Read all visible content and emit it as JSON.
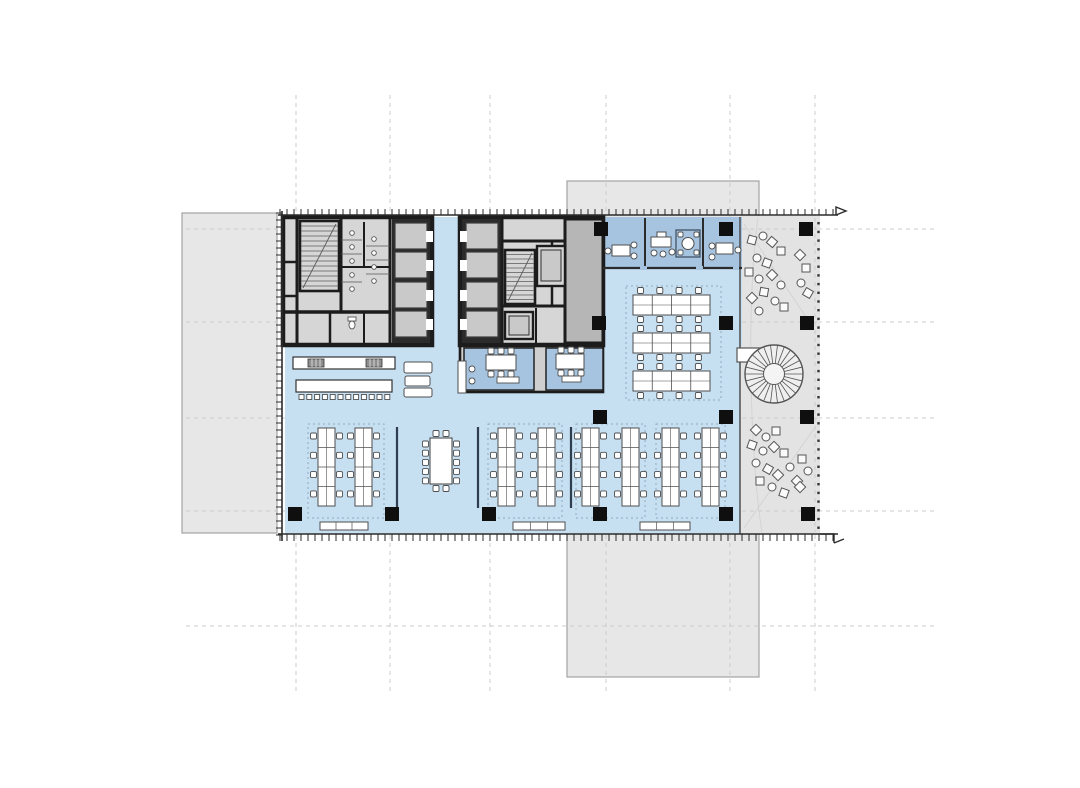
{
  "document": {
    "kind": "architectural-floor-plan",
    "description": "Office tower typical floor plan: two service cores, open-plan workstations, meeting rooms, cafe counter, terrace with spiral stair"
  },
  "palette": {
    "bg": "#ffffff",
    "slab_fill": "#e7e7e7",
    "slab_stroke": "#a3a3a3",
    "grid": "#cbcbcb",
    "blue_open": "#c6dff1",
    "blue_room": "#a6c4e0",
    "core_floor": "#d6d6d6",
    "core_wall": "#1c1c1c",
    "shaft": "#2b2b2b",
    "car_fill": "#c9c9c9",
    "car_stroke": "#3c3c3c",
    "gray_room": "#b6b6b6",
    "band_gray": "#cfcfcf",
    "terrace": "#e3e3e3",
    "terrace_path": "#d2d2d2",
    "furn_stroke": "#4f4f4f",
    "furn_fill": "#ffffff",
    "zone_dash": "#93a9bd",
    "partition": "#2f3e4e",
    "column": "#0f0f0f",
    "tick": "#2b2b2b",
    "fixture": "#555555"
  },
  "canvas": {
    "w": 1080,
    "h": 788
  },
  "context_slabs": [
    [
      182,
      213,
      95,
      320
    ],
    [
      567,
      181,
      192,
      496
    ]
  ],
  "grid": {
    "v": [
      296,
      390,
      490,
      606,
      730,
      815
    ],
    "v_y": [
      95,
      691
    ],
    "h": [
      229,
      322,
      418,
      511,
      626
    ],
    "h_x": [
      186,
      938
    ]
  },
  "areas": {
    "open": [
      [
        285,
        345,
        455,
        189
      ],
      [
        430,
        217,
        32,
        130
      ],
      [
        603,
        268,
        139,
        78
      ]
    ],
    "terrace": [
      740,
      216,
      80,
      318
    ],
    "meeting_band": [
      603,
      217,
      139,
      51
    ],
    "boundary": [
      740,
      217,
      740,
      534
    ]
  },
  "facade": {
    "top": {
      "x1": 278,
      "x2": 838,
      "y": 215,
      "step": 7,
      "len": 6
    },
    "bottom": {
      "x1": 278,
      "x2": 838,
      "y": 534,
      "step": 7,
      "len": 7
    },
    "left": {
      "x": 282,
      "y1": 211,
      "y2": 541,
      "step": 7,
      "len": 6
    },
    "right_dots": {
      "x": 818.5,
      "y1": 222,
      "y2": 530,
      "step": 8.7,
      "size": 2.4
    },
    "hooks": [
      "M836,215 l0,-8 l10,4 l-10,4",
      "M820,534 l14,0 l0,9",
      "M834,543 l10,-4"
    ]
  },
  "core1": {
    "base": [
      283,
      217,
      149,
      128
    ],
    "walls": [
      [
        297,
        219,
        297,
        343,
        3
      ],
      [
        341,
        219,
        341,
        312,
        3
      ],
      [
        390,
        219,
        390,
        343,
        3
      ],
      [
        283,
        262,
        297,
        262,
        2.5
      ],
      [
        283,
        296,
        297,
        296,
        2.5
      ],
      [
        285,
        312,
        390,
        312,
        3.5
      ],
      [
        330,
        312,
        330,
        343,
        2.5
      ],
      [
        364,
        222,
        364,
        267,
        2
      ],
      [
        341,
        267,
        390,
        267,
        2
      ],
      [
        364,
        312,
        364,
        343,
        2
      ]
    ],
    "stair": {
      "x": 300,
      "y": 221,
      "w": 39,
      "h": 70,
      "n": 13
    },
    "shaft": {
      "x": 392,
      "y": 219,
      "w": 38,
      "h": 124
    },
    "cars": [
      {
        "x": 395,
        "y": 223,
        "w": 32,
        "h": 26,
        "door": "R"
      },
      {
        "x": 395,
        "y": 252,
        "w": 32,
        "h": 26,
        "door": "R"
      },
      {
        "x": 395,
        "y": 282,
        "w": 32,
        "h": 26,
        "door": "R"
      },
      {
        "x": 395,
        "y": 311,
        "w": 32,
        "h": 26,
        "door": "R"
      }
    ],
    "urinals": [
      [
        352,
        233
      ],
      [
        352,
        247
      ],
      [
        352,
        261
      ],
      [
        352,
        275
      ],
      [
        352,
        289
      ],
      [
        374,
        239
      ],
      [
        374,
        253
      ],
      [
        374,
        267
      ],
      [
        374,
        281
      ]
    ],
    "stalls": [
      [
        341,
        240,
        362,
        240
      ],
      [
        341,
        254,
        362,
        254
      ],
      [
        366,
        246,
        390,
        246
      ],
      [
        366,
        260,
        390,
        260
      ],
      [
        366,
        274,
        390,
        274
      ],
      [
        341,
        282,
        362,
        282
      ]
    ],
    "wc": [
      [
        352,
        325
      ]
    ]
  },
  "core2": {
    "base": [
      460,
      217,
      143,
      128
    ],
    "walls": [
      [
        502,
        219,
        502,
        343,
        3
      ],
      [
        565,
        219,
        565,
        343,
        3
      ],
      [
        502,
        241,
        565,
        241,
        3
      ],
      [
        502,
        306,
        565,
        306,
        3
      ],
      [
        552,
        241,
        552,
        306,
        2.5
      ],
      [
        536,
        308,
        536,
        343,
        2
      ]
    ],
    "stair": {
      "x": 505,
      "y": 250,
      "w": 30,
      "h": 54,
      "n": 11
    },
    "shaft": {
      "x": 462,
      "y": 219,
      "w": 40,
      "h": 124
    },
    "cars": [
      {
        "x": 466,
        "y": 223,
        "w": 32,
        "h": 26,
        "door": "L"
      },
      {
        "x": 466,
        "y": 252,
        "w": 32,
        "h": 26,
        "door": "L"
      },
      {
        "x": 466,
        "y": 282,
        "w": 32,
        "h": 26,
        "door": "L"
      },
      {
        "x": 466,
        "y": 311,
        "w": 32,
        "h": 26,
        "door": "L"
      }
    ],
    "elev_box": {
      "box": [
        537,
        246,
        28,
        40
      ],
      "car": [
        541,
        250,
        20,
        31
      ]
    },
    "svc": {
      "box": [
        505,
        312,
        28,
        27
      ],
      "car": [
        509,
        316,
        20,
        19
      ]
    },
    "right_room": [
      565,
      219,
      38,
      124
    ]
  },
  "meeting_small": {
    "band": [
      460,
      346,
      143,
      46
    ],
    "rooms": [
      [
        464,
        348,
        70,
        42
      ],
      [
        546,
        348,
        57,
        42
      ]
    ],
    "tables": [
      {
        "x": 486,
        "y": 355,
        "w": 30,
        "h": 15,
        "chairs": 3
      },
      {
        "x": 556,
        "y": 354,
        "w": 28,
        "h": 15,
        "chairs": 3
      }
    ],
    "sideboards": [
      [
        497,
        377,
        22,
        6
      ],
      [
        562,
        376,
        19,
        6
      ]
    ]
  },
  "top_rooms": {
    "partitions": [
      645,
      703
    ],
    "wall_y": 268,
    "wall_x": [
      603,
      742
    ],
    "door_gaps": [
      [
        640,
        7
      ],
      [
        696,
        7
      ],
      [
        733,
        6
      ]
    ],
    "desks": [
      {
        "r": [
          612,
          245,
          18,
          11
        ],
        "chairs": [
          [
            608,
            251
          ],
          [
            634,
            245
          ],
          [
            634,
            256
          ]
        ]
      },
      {
        "r": [
          651,
          237,
          20,
          10
        ],
        "tab": [
          657,
          232,
          9,
          5
        ],
        "chairs": [
          [
            654,
            253
          ],
          [
            663,
            254
          ],
          [
            672,
            252
          ]
        ]
      },
      {
        "r": [
          716,
          243,
          17,
          11
        ],
        "chairs": [
          [
            712,
            246
          ],
          [
            712,
            257
          ],
          [
            738,
            250
          ]
        ]
      }
    ],
    "table_box": {
      "box": [
        676,
        230,
        24,
        27
      ],
      "circle": [
        688,
        243.5,
        6
      ],
      "seats": [
        [
          678,
          232
        ],
        [
          694,
          232
        ],
        [
          678,
          250
        ],
        [
          694,
          250
        ]
      ]
    }
  },
  "desk_rows": {
    "rows": [
      [
        633,
        295
      ],
      [
        633,
        333
      ],
      [
        633,
        371
      ]
    ],
    "w": 77,
    "h": 20,
    "cols": 4,
    "chairs": 4,
    "zone": [
      626,
      286,
      95,
      114
    ]
  },
  "desk_banks": {
    "x": [
      318,
      355,
      498,
      538,
      582,
      622,
      662,
      702
    ],
    "y": 428,
    "w": 17,
    "h": 78,
    "rows": 4,
    "zones": [
      [
        308,
        424,
        76,
        94
      ],
      [
        488,
        424,
        74,
        94
      ],
      [
        576,
        424,
        69,
        94
      ],
      [
        656,
        424,
        69,
        94
      ]
    ],
    "partitions": [
      397,
      478,
      571
    ],
    "part_y": [
      427,
      508
    ]
  },
  "conference": {
    "table": [
      430,
      438,
      22,
      46
    ],
    "side_chairs": 5,
    "end_chairs": 2
  },
  "counters": {
    "a": [
      293,
      357,
      102,
      12
    ],
    "a_patches": [
      [
        308,
        359,
        16,
        8
      ],
      [
        366,
        359,
        16,
        8
      ]
    ],
    "b": [
      296,
      380,
      96,
      12
    ],
    "stools": {
      "y": 394.5,
      "x0": 299,
      "n": 12,
      "step": 7.8,
      "s": 5
    }
  },
  "lounge": [
    [
      404,
      362,
      28,
      11
    ],
    [
      405,
      376,
      25,
      10
    ],
    [
      404,
      388,
      28,
      9
    ]
  ],
  "high_table": {
    "rect": [
      458,
      361,
      8,
      32
    ],
    "stools": [
      [
        472,
        369
      ],
      [
        472,
        381
      ]
    ]
  },
  "benches": [
    [
      320,
      522,
      48,
      8
    ],
    [
      513,
      522,
      52,
      8
    ],
    [
      640,
      522,
      50,
      8
    ]
  ],
  "columns": {
    "size": 14,
    "pts": [
      [
        594,
        222
      ],
      [
        719,
        222
      ],
      [
        799,
        222
      ],
      [
        592,
        316
      ],
      [
        719,
        316
      ],
      [
        800,
        316
      ],
      [
        593,
        410
      ],
      [
        719,
        410
      ],
      [
        800,
        410
      ],
      [
        288,
        507
      ],
      [
        385,
        507
      ],
      [
        482,
        507
      ],
      [
        593,
        507
      ],
      [
        719,
        507
      ],
      [
        801,
        507
      ]
    ]
  },
  "terrace_detail": {
    "overlay_h": [
      229,
      322,
      418,
      511
    ],
    "overlay_hx": [
      742,
      817
    ],
    "overlay_v": 815,
    "overlay_vy": [
      218,
      532
    ],
    "paths": [
      "M744,224 L816,332",
      "M744,528 L816,426",
      "M758,218 C746,300 750,460 762,532"
    ],
    "spiral": {
      "cx": 774,
      "cy": 374,
      "r_out": 29,
      "r_in": 10.5,
      "spokes": 26
    },
    "landing": [
      737,
      348,
      38,
      14
    ],
    "scatter": [
      [
        752,
        240,
        "s",
        15
      ],
      [
        763,
        236,
        "c",
        0
      ],
      [
        772,
        242,
        "s",
        40
      ],
      [
        781,
        251,
        "s",
        0
      ],
      [
        757,
        258,
        "c",
        0
      ],
      [
        767,
        263,
        "s",
        20
      ],
      [
        749,
        272,
        "s",
        0
      ],
      [
        759,
        279,
        "c",
        0
      ],
      [
        772,
        275,
        "s",
        45
      ],
      [
        781,
        285,
        "c",
        0
      ],
      [
        764,
        292,
        "s",
        10
      ],
      [
        752,
        298,
        "s",
        45
      ],
      [
        775,
        301,
        "c",
        0
      ],
      [
        784,
        307,
        "s",
        0
      ],
      [
        759,
        311,
        "c",
        0
      ],
      [
        800,
        255,
        "s",
        45
      ],
      [
        806,
        268,
        "s",
        0
      ],
      [
        801,
        283,
        "c",
        0
      ],
      [
        808,
        293,
        "s",
        30
      ],
      [
        756,
        430,
        "s",
        45
      ],
      [
        766,
        437,
        "c",
        0
      ],
      [
        776,
        431,
        "s",
        0
      ],
      [
        752,
        445,
        "s",
        20
      ],
      [
        763,
        451,
        "c",
        0
      ],
      [
        774,
        447,
        "s",
        45
      ],
      [
        784,
        453,
        "s",
        0
      ],
      [
        756,
        463,
        "c",
        0
      ],
      [
        768,
        469,
        "s",
        30
      ],
      [
        778,
        475,
        "s",
        45
      ],
      [
        790,
        467,
        "c",
        0
      ],
      [
        760,
        481,
        "s",
        0
      ],
      [
        772,
        487,
        "c",
        0
      ],
      [
        784,
        493,
        "s",
        20
      ],
      [
        797,
        481,
        "s",
        45
      ],
      [
        802,
        459,
        "s",
        0
      ],
      [
        808,
        471,
        "c",
        0
      ],
      [
        800,
        487,
        "s",
        45
      ]
    ]
  }
}
